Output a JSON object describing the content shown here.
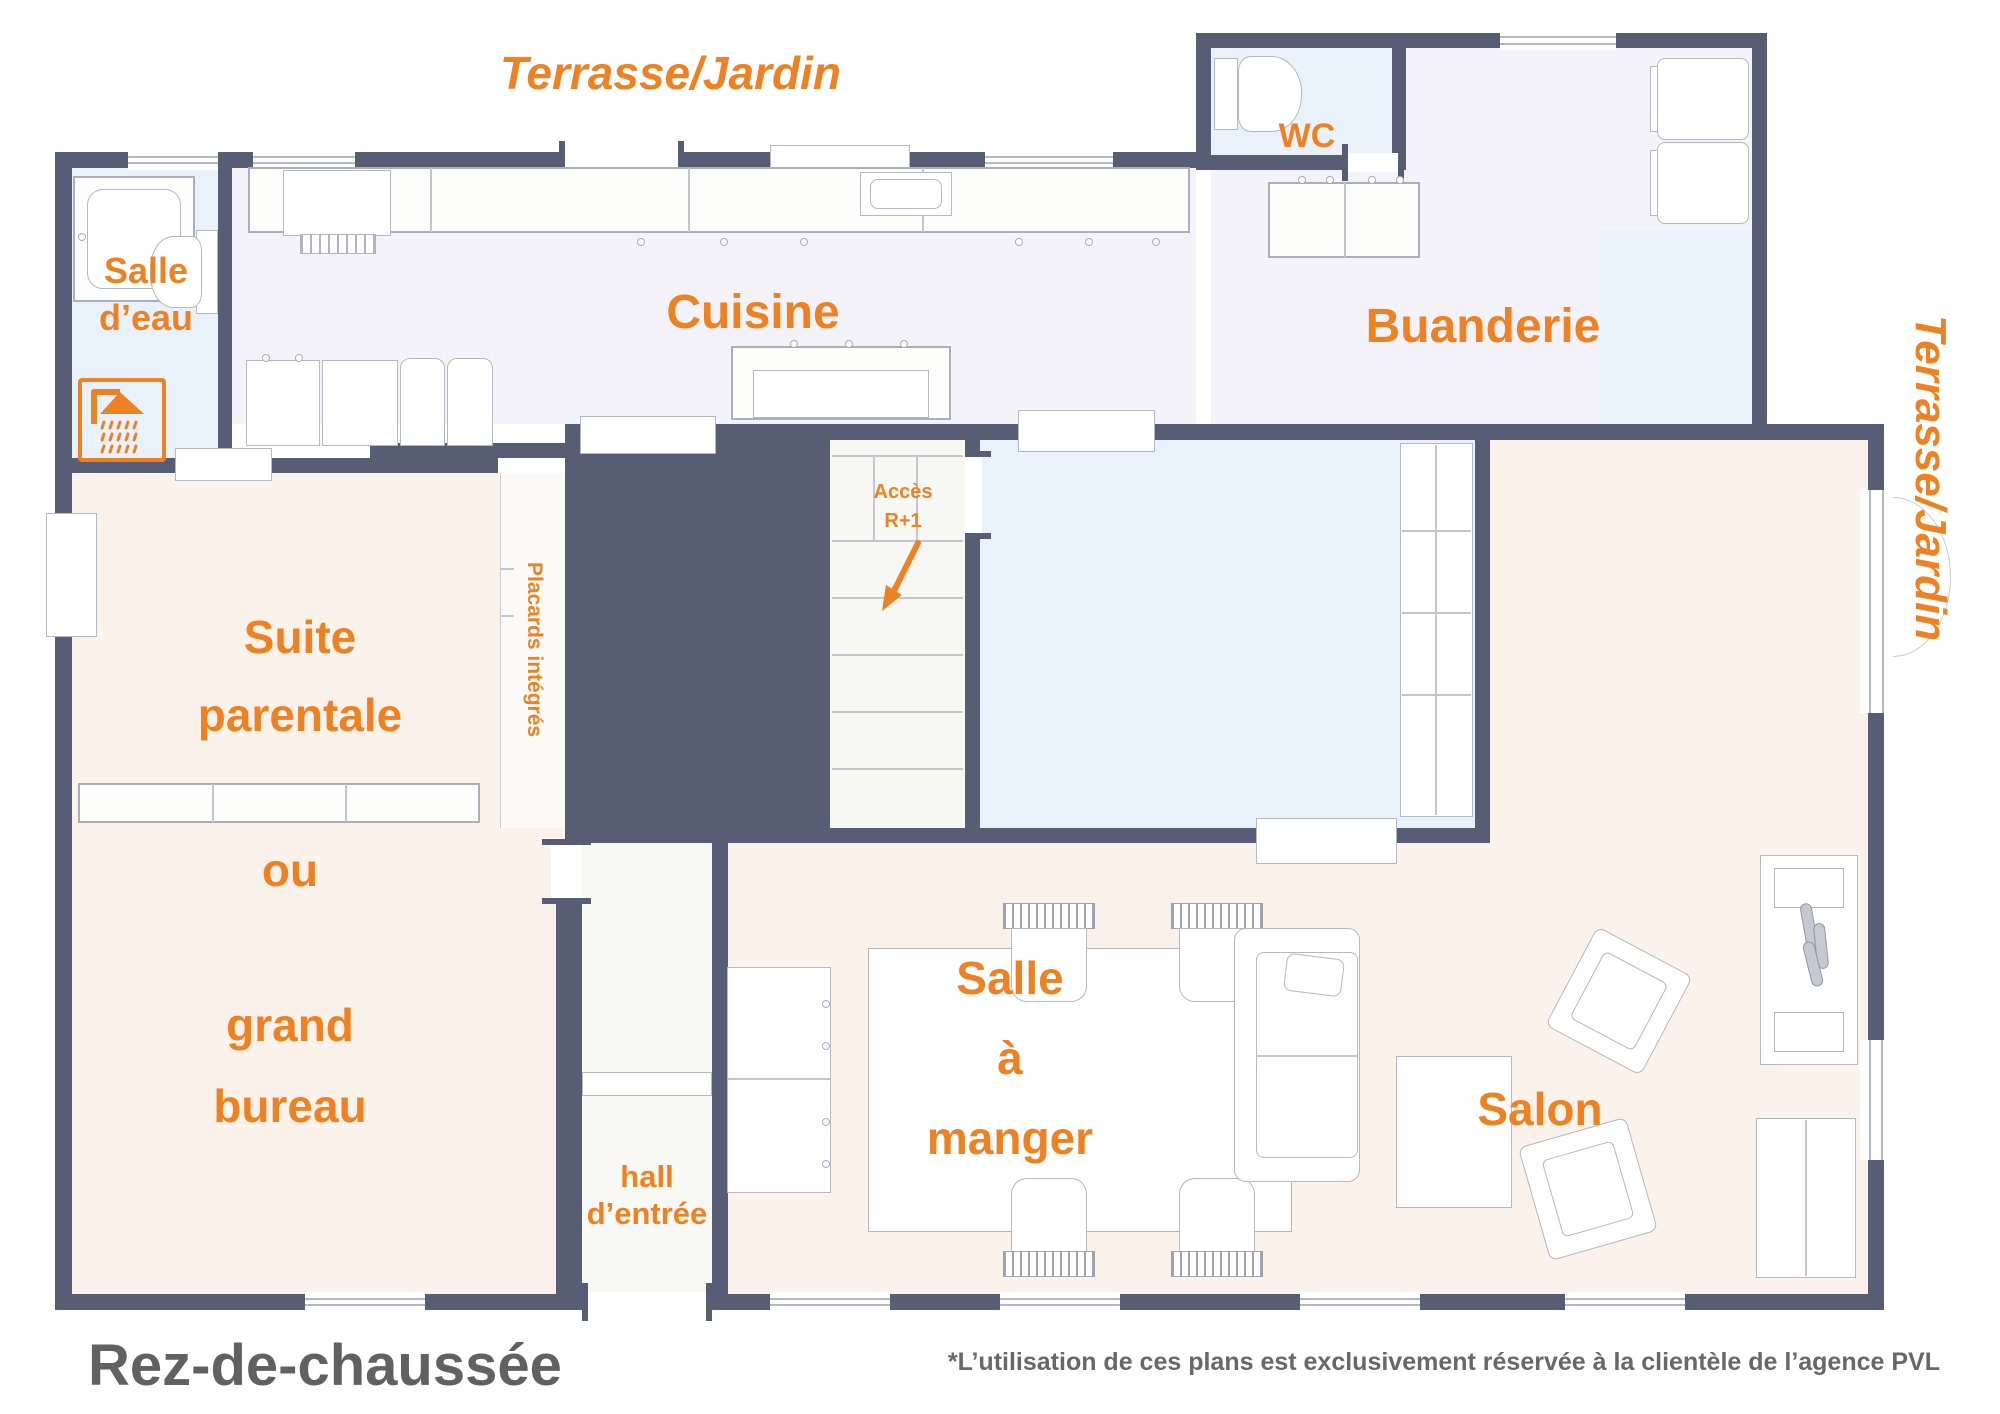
{
  "title": "Rez-de-chaussée",
  "footnote": "*L’utilisation de ces plans est exclusivement réservée à la clientèle de l’agence PVL",
  "outdoor": {
    "top": "Terrasse/Jardin",
    "right": "Terrasse/Jardin"
  },
  "rooms": {
    "salle_eau": "Salle\nd’eau",
    "cuisine": "Cuisine",
    "wc": "WC",
    "buanderie": "Buanderie",
    "suite": "Suite\nparentale",
    "suite_alt": "ou",
    "bureau": "grand\nbureau",
    "placards": "Placards intégrés",
    "acces": "Accès\nR+1",
    "salle_a_manger": "Salle\nà\nmanger",
    "salon": "Salon",
    "hall": "hall\nd’entrée"
  },
  "icons": {
    "shower": "shower-icon",
    "stairs_arrow": "stairs-down-arrow-icon"
  },
  "colors": {
    "wall": "#565d74",
    "accent": "#ee8122",
    "room_peach": "#fcf2ec",
    "room_lavender": "#f3f3f9",
    "room_blue": "#e9f1fb",
    "title_gray": "#616164"
  }
}
